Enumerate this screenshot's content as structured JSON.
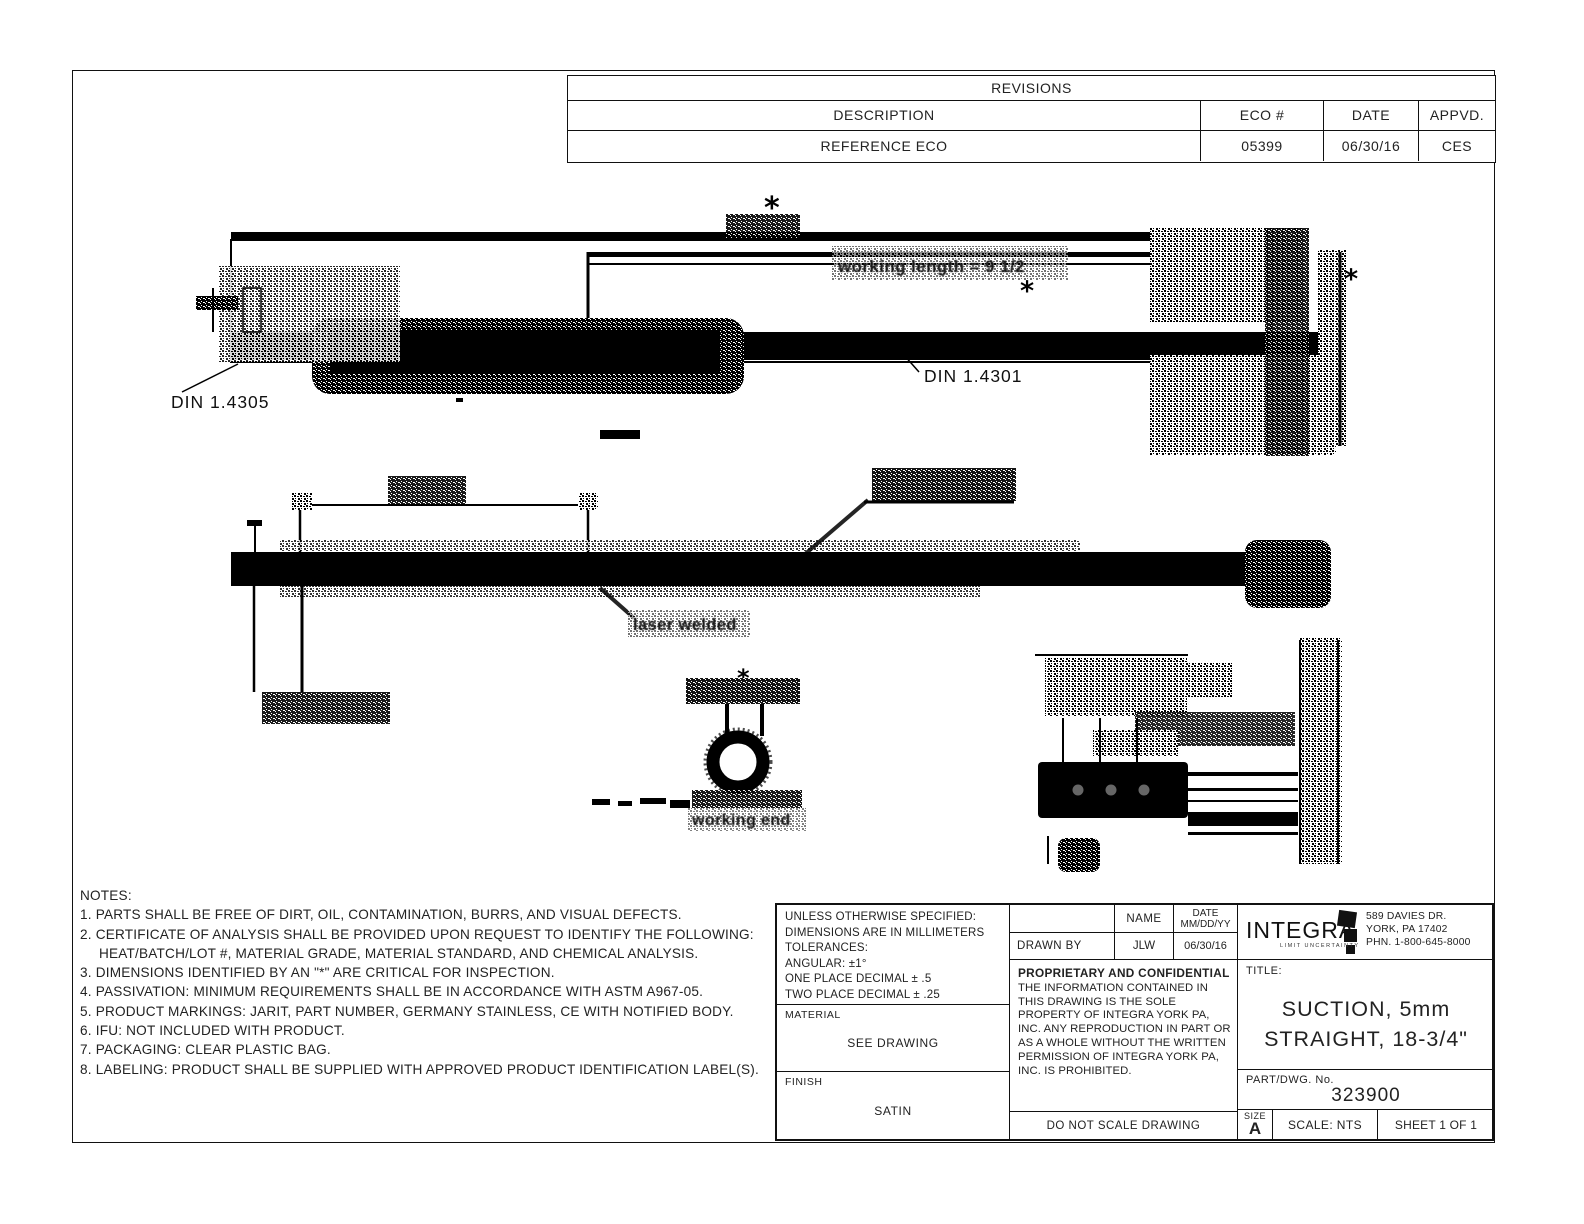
{
  "revisions": {
    "title": "REVISIONS",
    "columns": [
      "DESCRIPTION",
      "ECO #",
      "DATE",
      "APPVD."
    ],
    "rows": [
      [
        "REFERENCE ECO",
        "05399",
        "06/30/16",
        "CES"
      ]
    ]
  },
  "drawing": {
    "asterisk": "*",
    "labels": {
      "din_tip": "DIN 1.4305",
      "din_tube": "DIN 1.4301",
      "working_length": "working length = 9 1/2",
      "laser_welded": "laser welded",
      "working_end": "working end"
    }
  },
  "notes": {
    "title": "NOTES:",
    "items": [
      "1. PARTS SHALL BE FREE OF DIRT, OIL, CONTAMINATION, BURRS, AND VISUAL DEFECTS.",
      "2. CERTIFICATE OF ANALYSIS SHALL BE PROVIDED UPON REQUEST TO IDENTIFY THE FOLLOWING: HEAT/BATCH/LOT #, MATERIAL GRADE, MATERIAL STANDARD, AND CHEMICAL ANALYSIS.",
      "3. DIMENSIONS IDENTIFIED BY AN \"*\" ARE CRITICAL FOR INSPECTION.",
      "4. PASSIVATION: MINIMUM REQUIREMENTS SHALL BE IN ACCORDANCE WITH ASTM A967-05.",
      "5. PRODUCT MARKINGS: JARIT, PART NUMBER, GERMANY STAINLESS, CE WITH NOTIFIED BODY.",
      "6. IFU: NOT INCLUDED WITH PRODUCT.",
      "7. PACKAGING: CLEAR PLASTIC BAG.",
      "8. LABELING: PRODUCT SHALL BE SUPPLIED WITH APPROVED PRODUCT IDENTIFICATION LABEL(S)."
    ]
  },
  "title_block": {
    "tolerances": {
      "lines": [
        "UNLESS OTHERWISE SPECIFIED:",
        "DIMENSIONS ARE IN MILLIMETERS",
        "TOLERANCES:",
        "ANGULAR: ±1°",
        "ONE PLACE DECIMAL ± .5",
        "TWO PLACE DECIMAL ± .25"
      ]
    },
    "material_label": "MATERIAL",
    "material_value": "SEE DRAWING",
    "finish_label": "FINISH",
    "finish_value": "SATIN",
    "name_header": "NAME",
    "date_header_line1": "DATE",
    "date_header_line2": "MM/DD/YY",
    "drawn_by_label": "DRAWN BY",
    "drawn_by_name": "JLW",
    "drawn_by_date": "06/30/16",
    "proprietary_title": "PROPRIETARY AND CONFIDENTIAL",
    "proprietary_body": "THE INFORMATION CONTAINED IN THIS DRAWING IS THE SOLE PROPERTY OF INTEGRA YORK PA, INC.  ANY REPRODUCTION IN PART OR AS A WHOLE WITHOUT THE WRITTEN PERMISSION OF INTEGRA YORK PA, INC. IS PROHIBITED.",
    "do_not_scale": "DO NOT SCALE DRAWING",
    "company": {
      "name": "INTEGRA",
      "tagline": "LIMIT UNCERTAINTY",
      "address_line1": "589 DAVIES DR.",
      "address_line2": "YORK, PA 17402",
      "address_line3": "PHN. 1-800-645-8000"
    },
    "title_label": "TITLE:",
    "title_line1": "SUCTION, 5mm",
    "title_line2": "STRAIGHT, 18-3/4\"",
    "part_label": "PART/DWG. No.",
    "part_number": "323900",
    "size_label": "SIZE",
    "size_value": "A",
    "scale": "SCALE: NTS",
    "sheet": "SHEET 1 OF 1"
  }
}
